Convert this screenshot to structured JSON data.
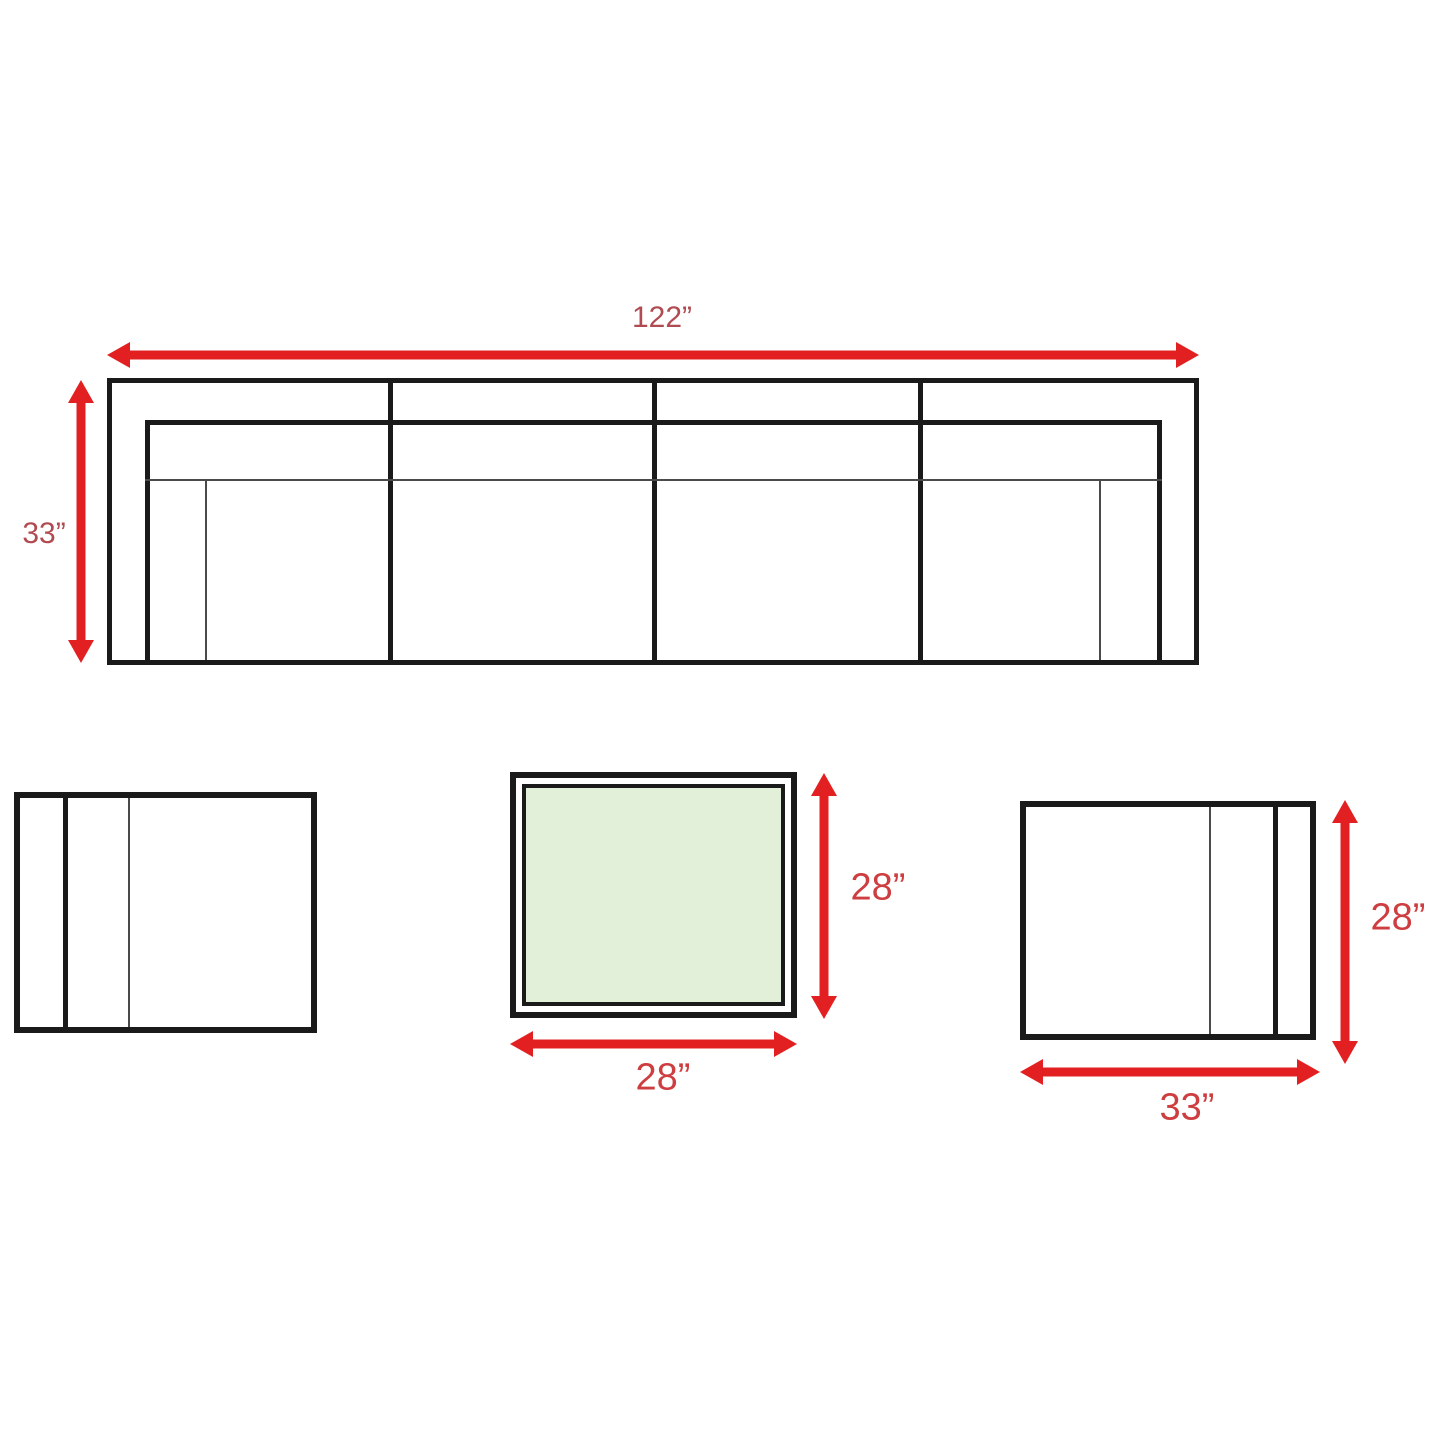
{
  "colors": {
    "arrow": "#e32021",
    "label_top": "#b04b52",
    "label_bottom": "#ce3d3f",
    "outline": "#1a1a1a",
    "thin_line": "#4a4a4a",
    "table_fill": "#e2efd9",
    "background": "#ffffff"
  },
  "sofa": {
    "width_label": "122”",
    "depth_label": "33”"
  },
  "coffee_table": {
    "depth_label": "28”",
    "width_label": "28”"
  },
  "side_table": {
    "depth_label": "28”",
    "width_label": "33”"
  }
}
